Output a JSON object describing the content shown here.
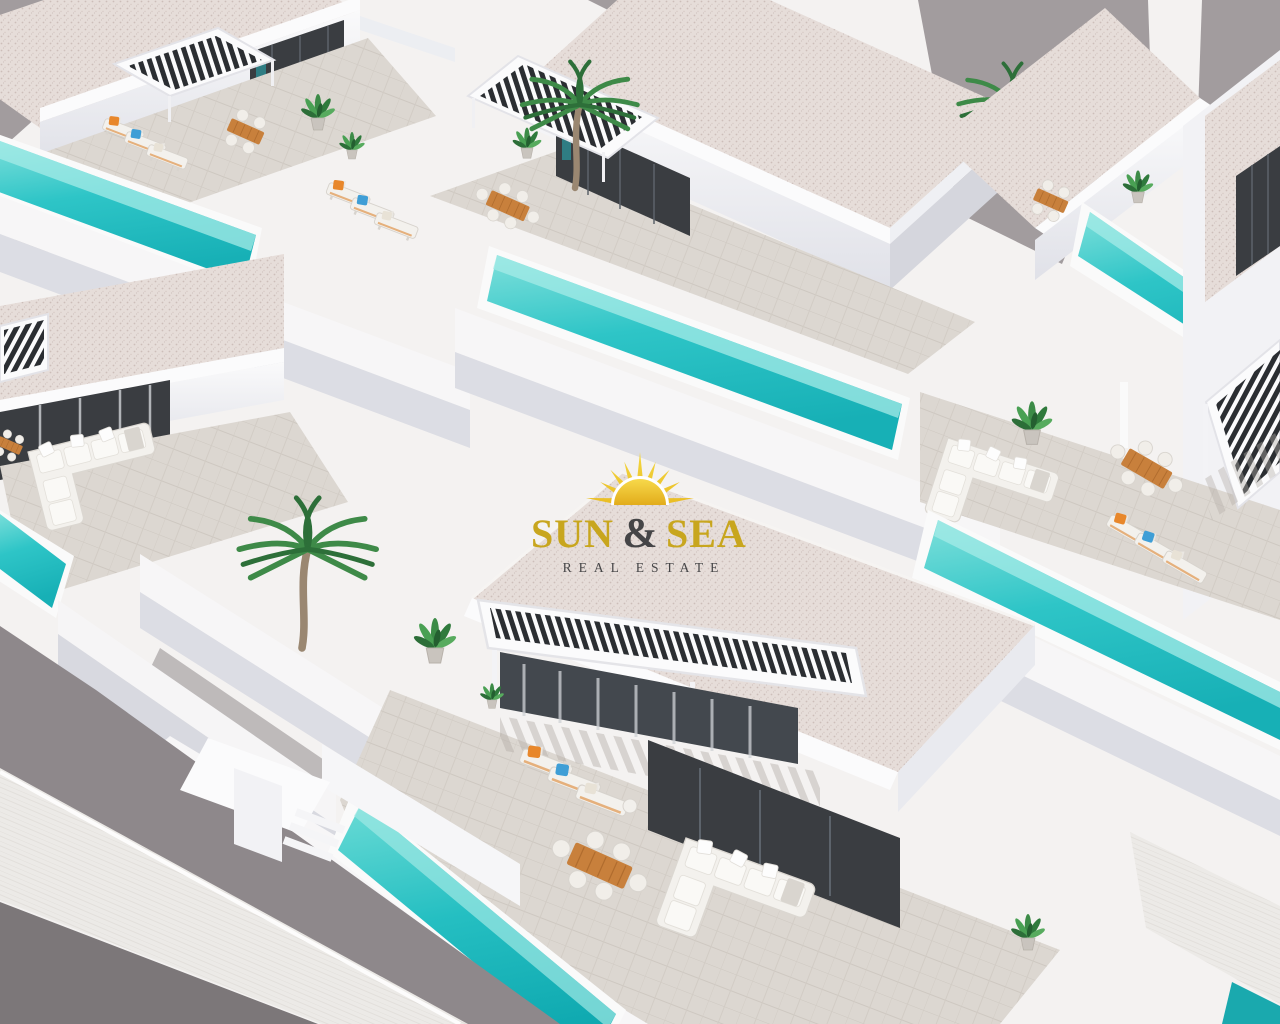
{
  "watermark": {
    "brand_word1": "SUN",
    "brand_amp": "&",
    "brand_word2": "SEA",
    "tagline": "REAL ESTATE"
  },
  "palette": {
    "backdrop_gray": "#a29c9e",
    "road_gray": "#7c7779",
    "wall_white": "#f7f6f7",
    "wall_shadow": "#d5d6dd",
    "roof_speckle": "#e6ddd9",
    "facade_charcoal": "#3a3d41",
    "pool_turquoise": "#2ec5c7",
    "pool_light": "#9fe8e4",
    "paver_gray": "#dcd7d1",
    "wood_orange": "#c8803c",
    "cushion_orange": "#e8872b",
    "cushion_blue": "#3f9ed6",
    "plant_green": "#3e8a48",
    "logo_gold": "#c8a61e",
    "logo_dark": "#454547"
  }
}
